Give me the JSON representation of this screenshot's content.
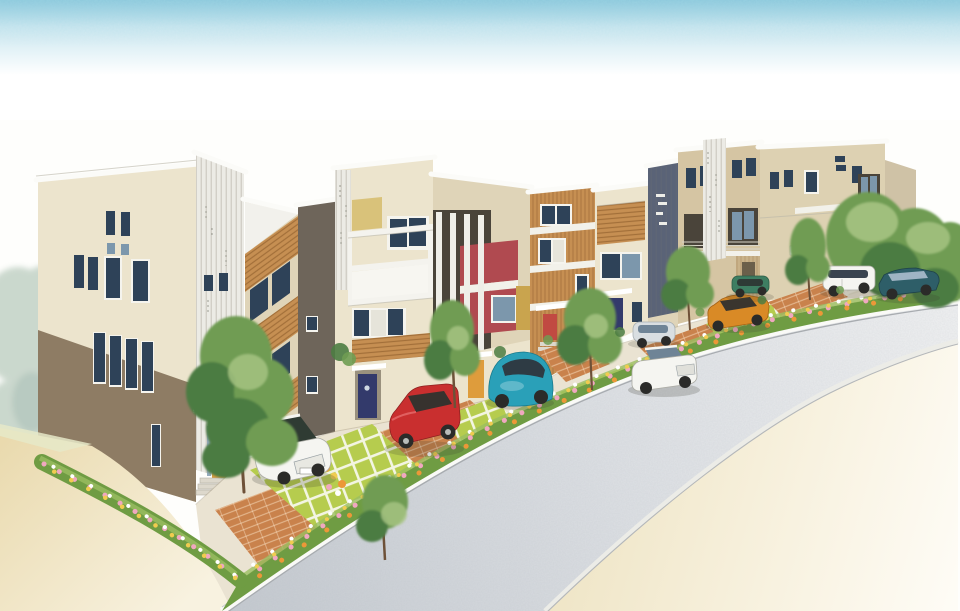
{
  "meta": {
    "type": "illustration",
    "setting": "Watercolor-style architect's perspective rendering of a row of nine modern three-storey townhouses along a gently curving suburban street, viewed from an elevated three-quarter angle; parked cars, street trees and flower beds line the curb; empty sand-toned ground fills the foreground corners; no text is visible in the image"
  },
  "palette": {
    "paper": "#FEFEFC",
    "sky_top": "#8CC8DC",
    "sky_mid": "#C9E6EF",
    "road_near": "#C6CBD1",
    "road_mid": "#DDE0E4",
    "road_far": "#F0F1F2",
    "parapet": "#FBFBF8",
    "curb": "#FAFAF7",
    "curb_line": "#A8ACB0",
    "sand": "#E9D9AC",
    "sand_pale": "#F8F2E0",
    "pavement": "#EAE3D2",
    "brick": "#C9824C",
    "turf": "#B6CC4E",
    "bed_green": "#6F9C43",
    "bed_light": "#9BBE62",
    "flower_pink": "#F0A8C0",
    "flower_white": "#FFFFFF",
    "flower_orange": "#EC9838",
    "flower_yellow": "#F0CC50",
    "tree_dark": "#4C7C42",
    "tree_mid": "#6F9C52",
    "tree_light": "#A9C585",
    "tree_faded": "#A9BFAF",
    "trunk": "#6E5138",
    "window": "#2E4258",
    "window_light": "#7C97AC",
    "frame": "#F5F4EE",
    "curtain": "#E6E4DA",
    "facade_cream": "#ECE4CD",
    "facade_cream2": "#DFD4B8",
    "facade_tan": "#D5C5A3",
    "facade_taupe": "#6E655A",
    "facade_brown": "#8E7C64",
    "facade_maroon": "#B04A50",
    "facade_wood": "#C68F52",
    "facade_bluegray": "#5A6377",
    "panel_white": "#ECEBE5",
    "recess_dark": "#4A443A",
    "door_orange": "#DE9C3C",
    "door_navy": "#333A6B",
    "door_coral": "#C14A42",
    "car_white": "#F5F5F1",
    "car_red": "#C92F2F",
    "car_teal": "#2AA0B8",
    "car_silver": "#D9DEE1",
    "car_orange": "#D98A26",
    "car_green": "#3E7E62",
    "car_darkteal": "#2E5E68",
    "car_glass": "#51616E",
    "tire": "#2B2B29"
  },
  "scene": {
    "sky": {
      "condition": "clear; speckled blue watercolor wash at the very top fading to white"
    },
    "street": {
      "surface": "light gray stippled asphalt running diagonally from lower-left to middle-right",
      "near_curb": "white concrete curb between planting beds and roadway",
      "far_side": "sand-beige sidewalk fading to white, lower right",
      "vacant_lot": "sand-beige open ground, lower left"
    },
    "buildings": [
      {
        "id": "house-1",
        "position": "far left corner unit",
        "facade": "cream stucco over taupe-brown base",
        "accent": "white vertical-batten stair tower with illegible pencil scribbles",
        "door": "orange with entry steps",
        "features": [
          "slit windows",
          "white entry canopy"
        ]
      },
      {
        "id": "house-2",
        "position": "second",
        "facade": "cream with diagonal timber-slat balcony bands",
        "accent": "dark textured pier on street corner",
        "door": "hidden behind tree",
        "features": [
          "tilted windows between slat bands"
        ]
      },
      {
        "id": "house-3",
        "position": "third",
        "facade": "cream with white balcony frame grid",
        "accent": "striped white side panel, ochre feature square, timber slat band",
        "door": "navy with porthole window",
        "features": [
          "white solid balcony panel"
        ]
      },
      {
        "id": "house-4",
        "position": "fourth",
        "facade": "crimson feature panels behind four slender white pillars",
        "accent": "ochre side panel, dark recess",
        "door": "orange",
        "features": [
          "white string course"
        ]
      },
      {
        "id": "house-5",
        "position": "fifth",
        "facade": "vertical timber siding with white string courses",
        "accent": "white parapet",
        "door": "coral red with white canopy",
        "features": [
          "curtained windows"
        ]
      },
      {
        "id": "house-6",
        "position": "sixth",
        "facade": "cream with horizontal timber slat screen",
        "accent": "slate blue-gray service tower with white tally marks",
        "door": "navy with white canopy",
        "features": [
          "air-conditioner unit"
        ]
      },
      {
        "id": "house-7",
        "position": "seventh",
        "facade": "sand-beige",
        "accent": "white louver panel with pencil scribbles",
        "door": "timber-clad entry surround",
        "features": [
          "two dark recessed balconies with railings"
        ]
      },
      {
        "id": "house-8",
        "position": "eighth, long block",
        "facade": "beige",
        "accent": "white batten screen, recessed corner balcony with railing",
        "door": "dark narrow door",
        "features": [
          "small paired windows",
          "white balcony slabs"
        ]
      },
      {
        "id": "house-9",
        "position": "far end sliver, mostly hidden by street trees",
        "facade": "beige",
        "accent": "",
        "door": "",
        "features": []
      }
    ],
    "vehicles": [
      {
        "id": "car-1",
        "type": "estate wagon",
        "color": "white",
        "location": "turf-block driveway of house 2, nose toward street"
      },
      {
        "id": "car-2",
        "type": "sedan",
        "color": "red",
        "location": "driveway of house 3"
      },
      {
        "id": "car-3",
        "type": "round-backed compact",
        "color": "teal",
        "location": "driveway of house 4"
      },
      {
        "id": "car-4",
        "type": "kei hatchback",
        "color": "silver white",
        "location": "walkway in front of house 6"
      },
      {
        "id": "car-5",
        "type": "sedan",
        "color": "white",
        "location": "parallel-parked on the street"
      },
      {
        "id": "car-6",
        "type": "coupe",
        "color": "amber orange",
        "location": "parking pad of house 7"
      },
      {
        "id": "car-7",
        "type": "compact",
        "color": "green",
        "location": "parking pad behind the orange coupe"
      },
      {
        "id": "car-8",
        "type": "minivan",
        "color": "white",
        "location": "parking pad of house 8"
      },
      {
        "id": "car-9",
        "type": "sedan",
        "color": "dark teal",
        "location": "parking pad at far right"
      }
    ],
    "landscaping": {
      "street_trees": 8,
      "left_edge": "pale faded watercolor trees",
      "right_edge": "dense green tree grove behind parked cars",
      "flower_beds": "continuous curbside bed with pink, white, orange and yellow flowers",
      "paving": "terracotta brick aprons alternating with white-jointed turf-block squares"
    }
  }
}
